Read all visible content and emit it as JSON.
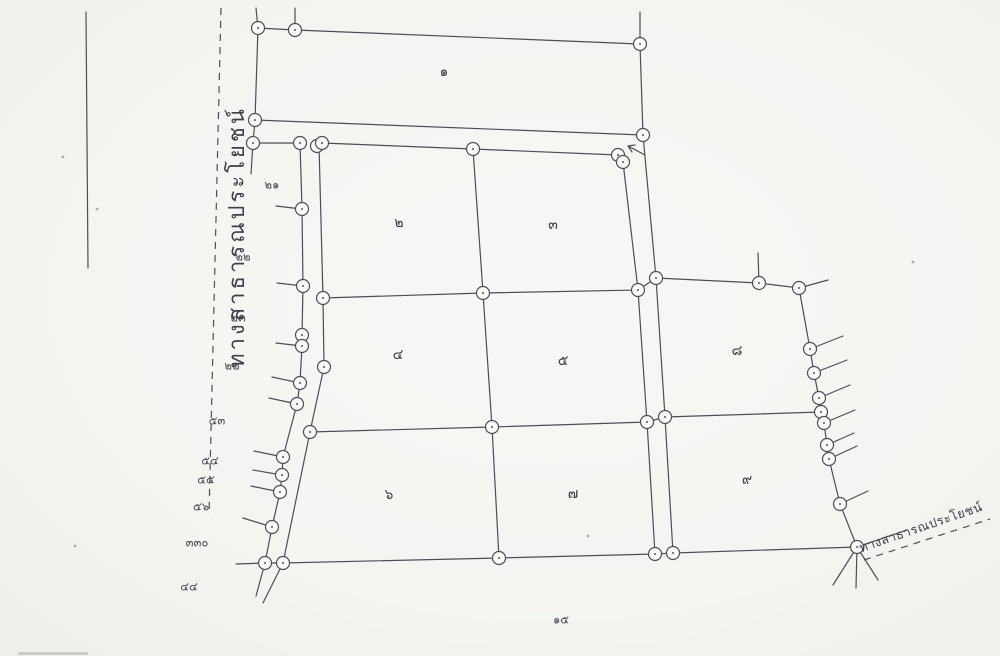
{
  "document": {
    "kind": "scanned cadastral survey sketch",
    "paper_color": "#f5f4f1",
    "ink_color": "#4e4e52",
    "circle_fill": "#faf9f6"
  },
  "road_labels": {
    "west": {
      "text": "ทางสาธารณประโยชน์",
      "x": 238,
      "y": 237,
      "rotation": -90,
      "font_size": 22,
      "letter_spacing": 3
    },
    "southeast": {
      "text": "ทางสาธารณประโยชน์",
      "x": 921,
      "y": 528,
      "rotation": -19,
      "font_size": 12.5,
      "letter_spacing": 0.5
    }
  },
  "parcel_numbers": [
    {
      "text": "๑",
      "value": 1,
      "x": 444,
      "y": 72
    },
    {
      "text": "๒",
      "value": 2,
      "x": 399,
      "y": 223
    },
    {
      "text": "๓",
      "value": 3,
      "x": 553,
      "y": 225
    },
    {
      "text": "๔",
      "value": 4,
      "x": 398,
      "y": 355
    },
    {
      "text": "๕",
      "value": 5,
      "x": 563,
      "y": 361
    },
    {
      "text": "๘",
      "value": 8,
      "x": 737,
      "y": 351
    },
    {
      "text": "๖",
      "value": 6,
      "x": 389,
      "y": 495
    },
    {
      "text": "๗",
      "value": 7,
      "x": 573,
      "y": 494
    },
    {
      "text": "๙",
      "value": 9,
      "x": 747,
      "y": 480
    }
  ],
  "boundary_marker_labels": [
    {
      "text": "๒๑",
      "value": 21,
      "x": 272,
      "y": 185
    },
    {
      "text": "๒๒",
      "value": 22,
      "x": 243,
      "y": 257
    },
    {
      "text": "๒๓",
      "value": 23,
      "x": 238,
      "y": 318
    },
    {
      "text": "๒๒",
      "value": 22,
      "x": 232,
      "y": 366
    },
    {
      "text": "๕๓",
      "value": 53,
      "x": 217,
      "y": 421
    },
    {
      "text": "๕๔",
      "value": 54,
      "x": 210,
      "y": 461
    },
    {
      "text": "๕๕",
      "value": 55,
      "x": 206,
      "y": 480
    },
    {
      "text": "๕๖",
      "value": 56,
      "x": 201,
      "y": 507
    },
    {
      "text": "๓๓๐",
      "value": 330,
      "x": 197,
      "y": 543
    },
    {
      "text": "๔๔",
      "value": 44,
      "x": 189,
      "y": 587
    }
  ],
  "south_label": {
    "text": "๑๕",
    "value": 15,
    "x": 561,
    "y": 620
  },
  "geometry": {
    "stroke_width": 1.2,
    "circle_radius": 6.5,
    "polylines": [
      {
        "name": "page-edge-line",
        "points": [
          [
            86,
            12
          ],
          [
            88,
            268
          ]
        ]
      },
      {
        "name": "north-stub-a",
        "points": [
          [
            256,
            8
          ],
          [
            258,
            28
          ]
        ]
      },
      {
        "name": "north-stub-b",
        "points": [
          [
            295,
            8
          ],
          [
            295,
            30
          ]
        ]
      },
      {
        "name": "north-stub-c",
        "points": [
          [
            640,
            12
          ],
          [
            640,
            44
          ]
        ]
      },
      {
        "name": "parcel-1-outline",
        "points": [
          [
            258,
            28
          ],
          [
            295,
            30
          ],
          [
            640,
            44
          ],
          [
            643,
            135
          ],
          [
            255,
            120
          ],
          [
            258,
            28
          ]
        ]
      },
      {
        "name": "west-connector",
        "points": [
          [
            255,
            120
          ],
          [
            253,
            143
          ],
          [
            251,
            174
          ]
        ]
      },
      {
        "name": "west-top-link",
        "points": [
          [
            253,
            143
          ],
          [
            300,
            143
          ]
        ]
      },
      {
        "name": "west-boundary",
        "points": [
          [
            300,
            143
          ],
          [
            302,
            209
          ],
          [
            303,
            286
          ],
          [
            302,
            335
          ],
          [
            302,
            346
          ],
          [
            300,
            383
          ],
          [
            297,
            404
          ],
          [
            283,
            457
          ],
          [
            282,
            475
          ],
          [
            280,
            492
          ],
          [
            272,
            527
          ],
          [
            265,
            563
          ],
          [
            256,
            596
          ]
        ]
      },
      {
        "name": "inner-west-edge",
        "points": [
          [
            319,
            145
          ],
          [
            323,
            298
          ],
          [
            324,
            367
          ],
          [
            310,
            432
          ],
          [
            283,
            563
          ],
          [
            263,
            603
          ]
        ]
      },
      {
        "name": "inner-north-edge",
        "points": [
          [
            322,
            143
          ],
          [
            473,
            149
          ],
          [
            618,
            155
          ]
        ]
      },
      {
        "name": "central-divider",
        "points": [
          [
            473,
            149
          ],
          [
            483,
            293
          ],
          [
            492,
            427
          ],
          [
            499,
            558
          ]
        ]
      },
      {
        "name": "strip-west-line",
        "points": [
          [
            623,
            162
          ],
          [
            638,
            290
          ],
          [
            647,
            422
          ],
          [
            655,
            554
          ]
        ]
      },
      {
        "name": "strip-east-line",
        "points": [
          [
            643,
            135
          ],
          [
            656,
            278
          ],
          [
            665,
            417
          ],
          [
            673,
            553
          ]
        ]
      },
      {
        "name": "row-divider-north",
        "points": [
          [
            323,
            298
          ],
          [
            483,
            293
          ],
          [
            638,
            290
          ],
          [
            656,
            278
          ],
          [
            759,
            283
          ],
          [
            799,
            288
          ]
        ]
      },
      {
        "name": "row-divider-south",
        "points": [
          [
            310,
            432
          ],
          [
            492,
            427
          ],
          [
            647,
            422
          ],
          [
            665,
            417
          ],
          [
            821,
            412
          ]
        ]
      },
      {
        "name": "east-boundary",
        "points": [
          [
            799,
            288
          ],
          [
            810,
            349
          ],
          [
            814,
            373
          ],
          [
            819,
            398
          ],
          [
            821,
            412
          ],
          [
            824,
            423
          ],
          [
            827,
            445
          ],
          [
            829,
            459
          ],
          [
            840,
            504
          ],
          [
            857,
            547
          ]
        ]
      },
      {
        "name": "south-boundary",
        "points": [
          [
            265,
            563
          ],
          [
            283,
            563
          ],
          [
            499,
            558
          ],
          [
            655,
            554
          ],
          [
            673,
            553
          ],
          [
            857,
            547
          ]
        ]
      },
      {
        "name": "junction-ray-a",
        "points": [
          [
            857,
            547
          ],
          [
            833,
            585
          ]
        ]
      },
      {
        "name": "junction-ray-b",
        "points": [
          [
            857,
            547
          ],
          [
            856,
            588
          ]
        ]
      },
      {
        "name": "junction-ray-c",
        "points": [
          [
            857,
            547
          ],
          [
            878,
            580
          ]
        ]
      },
      {
        "name": "road-upper-edge",
        "points": [
          [
            857,
            547
          ],
          [
            907,
            530
          ]
        ]
      },
      {
        "name": "marker-post",
        "points": [
          [
            759,
            283
          ],
          [
            758,
            253
          ]
        ]
      },
      {
        "name": "arrow-mark",
        "points": [
          [
            645,
            155
          ],
          [
            628,
            146
          ],
          [
            635,
            145
          ],
          [
            628,
            146
          ],
          [
            632,
            152
          ]
        ]
      }
    ],
    "dashed_lines": [
      {
        "name": "west-road-dashed",
        "points": [
          [
            221,
            8
          ],
          [
            209,
            515
          ]
        ]
      },
      {
        "name": "southeast-road-dashed",
        "points": [
          [
            864,
            560
          ],
          [
            990,
            519
          ]
        ]
      }
    ],
    "ticks": [
      [
        [
          302,
          209
        ],
        [
          276,
          206
        ]
      ],
      [
        [
          303,
          286
        ],
        [
          277,
          283
        ]
      ],
      [
        [
          302,
          346
        ],
        [
          276,
          343
        ]
      ],
      [
        [
          300,
          383
        ],
        [
          272,
          377
        ]
      ],
      [
        [
          297,
          404
        ],
        [
          269,
          398
        ]
      ],
      [
        [
          283,
          457
        ],
        [
          254,
          451
        ]
      ],
      [
        [
          282,
          475
        ],
        [
          253,
          470
        ]
      ],
      [
        [
          280,
          492
        ],
        [
          251,
          486
        ]
      ],
      [
        [
          272,
          527
        ],
        [
          243,
          518
        ]
      ],
      [
        [
          265,
          563
        ],
        [
          236,
          564
        ]
      ],
      [
        [
          799,
          288
        ],
        [
          828,
          280
        ]
      ],
      [
        [
          810,
          349
        ],
        [
          843,
          336
        ]
      ],
      [
        [
          814,
          373
        ],
        [
          847,
          360
        ]
      ],
      [
        [
          819,
          398
        ],
        [
          850,
          385
        ]
      ],
      [
        [
          824,
          423
        ],
        [
          855,
          410
        ]
      ],
      [
        [
          827,
          445
        ],
        [
          854,
          433
        ]
      ],
      [
        [
          829,
          459
        ],
        [
          857,
          446
        ]
      ],
      [
        [
          840,
          504
        ],
        [
          868,
          491
        ]
      ]
    ],
    "circles": [
      [
        258,
        28
      ],
      [
        295,
        30
      ],
      [
        640,
        44
      ],
      [
        643,
        135
      ],
      [
        255,
        120
      ],
      [
        253,
        143
      ],
      [
        300,
        143
      ],
      [
        302,
        209
      ],
      [
        303,
        286
      ],
      [
        302,
        335
      ],
      [
        302,
        346
      ],
      [
        300,
        383
      ],
      [
        297,
        404
      ],
      [
        283,
        457
      ],
      [
        282,
        475
      ],
      [
        280,
        492
      ],
      [
        272,
        527
      ],
      [
        265,
        563
      ],
      [
        317,
        146
      ],
      [
        322,
        143
      ],
      [
        323,
        298
      ],
      [
        324,
        367
      ],
      [
        310,
        432
      ],
      [
        283,
        563
      ],
      [
        473,
        149
      ],
      [
        618,
        155
      ],
      [
        623,
        162
      ],
      [
        483,
        293
      ],
      [
        492,
        427
      ],
      [
        499,
        558
      ],
      [
        638,
        290
      ],
      [
        647,
        422
      ],
      [
        655,
        554
      ],
      [
        656,
        278
      ],
      [
        665,
        417
      ],
      [
        673,
        553
      ],
      [
        759,
        283
      ],
      [
        799,
        288
      ],
      [
        810,
        349
      ],
      [
        814,
        373
      ],
      [
        819,
        398
      ],
      [
        821,
        412
      ],
      [
        824,
        423
      ],
      [
        827,
        445
      ],
      [
        829,
        459
      ],
      [
        840,
        504
      ],
      [
        857,
        547
      ]
    ],
    "specks": [
      [
        97,
        209
      ],
      [
        63,
        157
      ],
      [
        75,
        546
      ],
      [
        588,
        536
      ],
      [
        913,
        262
      ]
    ]
  }
}
